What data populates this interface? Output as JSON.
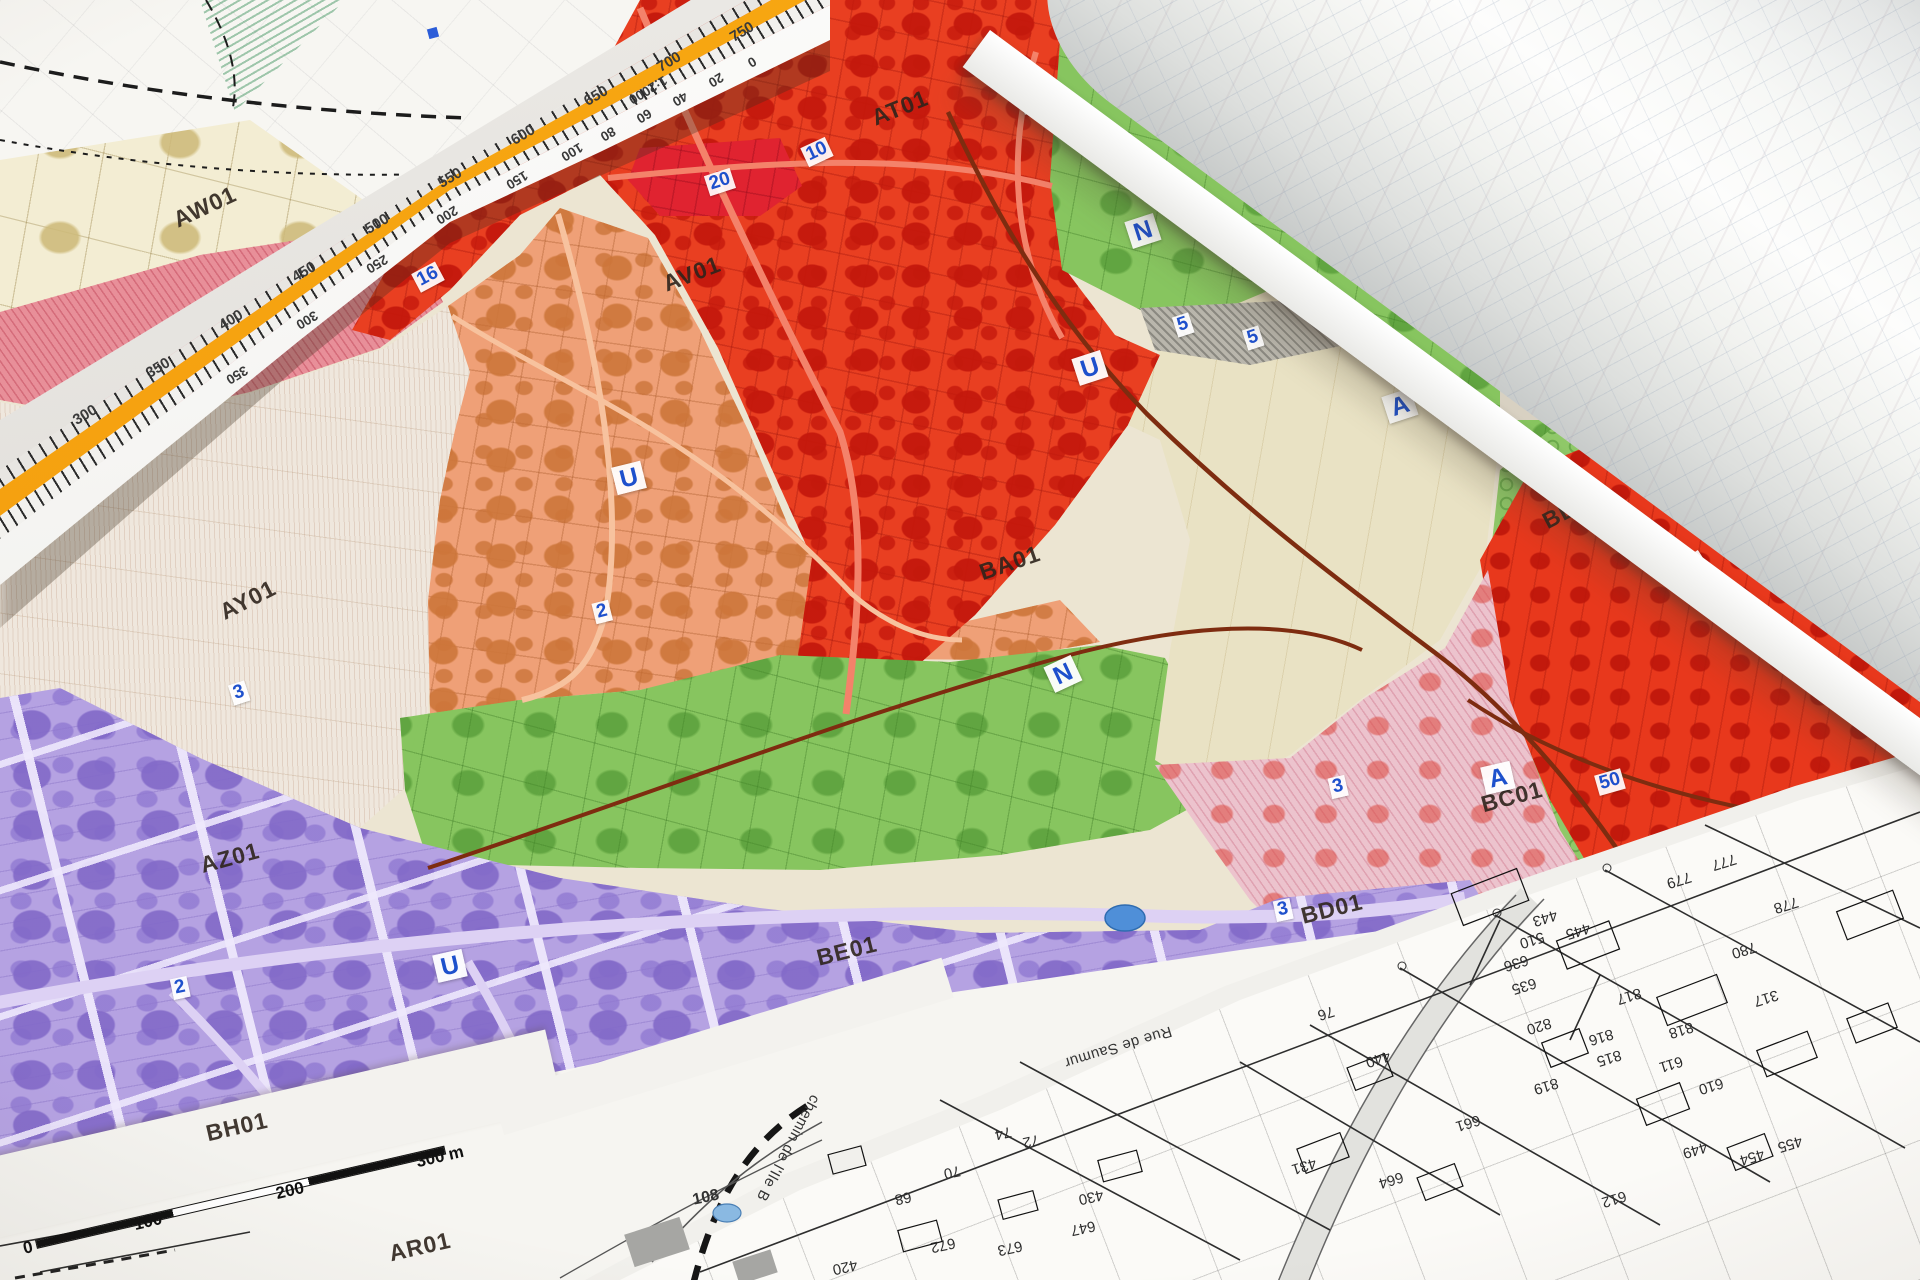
{
  "scene": {
    "description": "Photograph of paper town-planning zoning maps (PLU) with a triangular scale ruler, a rolled plan and cadastral parcel sheets"
  },
  "palette": {
    "zone_red": "#e93f21",
    "zone_orange": "#efa077",
    "zone_green": "#87c55f",
    "zone_purple": "#b5a2e2",
    "zone_cream": "#e9e2c4",
    "zone_pink": "#ecc3cd",
    "badge_blue": "#1e50cc",
    "ruler_orange": "#f59d0b"
  },
  "zoning_map": {
    "zone_labels": [
      {
        "t": "AW01",
        "x": 205,
        "y": 207,
        "r": -25
      },
      {
        "t": "AT01",
        "x": 900,
        "y": 108,
        "r": -22
      },
      {
        "t": "AV01",
        "x": 692,
        "y": 274,
        "r": -21
      },
      {
        "t": "AY01",
        "x": 248,
        "y": 600,
        "r": -27
      },
      {
        "t": "BA01",
        "x": 1010,
        "y": 563,
        "r": -19
      },
      {
        "t": "AZ01",
        "x": 230,
        "y": 858,
        "r": -15
      },
      {
        "t": "BB01",
        "x": 1572,
        "y": 508,
        "r": -28
      },
      {
        "t": "BC01",
        "x": 1512,
        "y": 797,
        "r": -15
      },
      {
        "t": "BD01",
        "x": 1332,
        "y": 909,
        "r": -14
      },
      {
        "t": "BE01",
        "x": 847,
        "y": 951,
        "r": -14
      },
      {
        "t": "BH01",
        "x": 237,
        "y": 1127,
        "r": -13
      },
      {
        "t": "AR01",
        "x": 420,
        "y": 1247,
        "r": -13
      }
    ],
    "class_badges": [
      {
        "t": "U",
        "x": 1035,
        "y": 97,
        "r": -18
      },
      {
        "t": "U",
        "x": 1090,
        "y": 368,
        "r": -18
      },
      {
        "t": "U",
        "x": 629,
        "y": 478,
        "r": -14
      },
      {
        "t": "U",
        "x": 1693,
        "y": 570,
        "r": -33
      },
      {
        "t": "U",
        "x": 450,
        "y": 966,
        "r": -13
      },
      {
        "t": "N",
        "x": 1143,
        "y": 231,
        "r": -18
      },
      {
        "t": "N",
        "x": 1063,
        "y": 674,
        "r": -25
      },
      {
        "t": "A",
        "x": 1400,
        "y": 406,
        "r": -18
      },
      {
        "t": "A",
        "x": 1498,
        "y": 778,
        "r": -13
      }
    ],
    "number_badges": [
      {
        "t": "10",
        "x": 817,
        "y": 152,
        "r": -25
      },
      {
        "t": "20",
        "x": 720,
        "y": 182,
        "r": -18
      },
      {
        "t": "16",
        "x": 428,
        "y": 277,
        "r": -28
      },
      {
        "t": "2",
        "x": 602,
        "y": 612,
        "r": -14
      },
      {
        "t": "2",
        "x": 180,
        "y": 988,
        "r": -12
      },
      {
        "t": "3",
        "x": 239,
        "y": 693,
        "r": -18
      },
      {
        "t": "3",
        "x": 1283,
        "y": 910,
        "r": -12
      },
      {
        "t": "3",
        "x": 1338,
        "y": 787,
        "r": -13
      },
      {
        "t": "5",
        "x": 1183,
        "y": 325,
        "r": -18
      },
      {
        "t": "5",
        "x": 1253,
        "y": 338,
        "r": -18
      },
      {
        "t": "50",
        "x": 1610,
        "y": 782,
        "r": -16
      }
    ],
    "scale_bar_labels": [
      {
        "t": "0",
        "x": 28,
        "y": 1248,
        "r": -13
      },
      {
        "t": "100",
        "x": 148,
        "y": 1222,
        "r": -13
      },
      {
        "t": "200",
        "x": 290,
        "y": 1191,
        "r": -13
      },
      {
        "t": "300 m",
        "x": 440,
        "y": 1157,
        "r": -13
      }
    ]
  },
  "ruler": {
    "top_numbers": [
      {
        "t": "300",
        "x": 85,
        "y": 415,
        "r": -31
      },
      {
        "t": "350",
        "x": 158,
        "y": 368,
        "r": -31
      },
      {
        "t": "400",
        "x": 231,
        "y": 320,
        "r": -31
      },
      {
        "t": "450",
        "x": 304,
        "y": 272,
        "r": -31
      },
      {
        "t": "500",
        "x": 377,
        "y": 224,
        "r": -31
      },
      {
        "t": "550",
        "x": 450,
        "y": 178,
        "r": -31
      },
      {
        "t": "600",
        "x": 523,
        "y": 135,
        "r": -31
      },
      {
        "t": "650",
        "x": 596,
        "y": 96,
        "r": -31
      },
      {
        "t": "700",
        "x": 669,
        "y": 62,
        "r": -31
      },
      {
        "t": "750",
        "x": 742,
        "y": 32,
        "r": -31
      }
    ],
    "bottom_numbers": [
      {
        "t": "1:2000",
        "x": 648,
        "y": 90,
        "r": 149
      },
      {
        "t": "0",
        "x": 752,
        "y": 62,
        "r": 149
      },
      {
        "t": "20",
        "x": 716,
        "y": 80,
        "r": 149
      },
      {
        "t": "40",
        "x": 680,
        "y": 99,
        "r": 149
      },
      {
        "t": "60",
        "x": 644,
        "y": 116,
        "r": 149
      },
      {
        "t": "80",
        "x": 608,
        "y": 134,
        "r": 149
      },
      {
        "t": "100",
        "x": 572,
        "y": 152,
        "r": 149
      },
      {
        "t": "150",
        "x": 517,
        "y": 180,
        "r": 149
      },
      {
        "t": "200",
        "x": 447,
        "y": 215,
        "r": 149
      },
      {
        "t": "250",
        "x": 377,
        "y": 264,
        "r": 149
      },
      {
        "t": "300",
        "x": 307,
        "y": 320,
        "r": 149
      },
      {
        "t": "350",
        "x": 237,
        "y": 375,
        "r": 149
      }
    ]
  },
  "cadastral_sheet": {
    "street_labels": [
      {
        "t": "Rue de Saumur",
        "x": 1118,
        "y": 1047,
        "r": 163
      },
      {
        "t": "chemin de l'Ile B",
        "x": 788,
        "y": 1148,
        "r": 118
      }
    ],
    "other_labels": [
      {
        "t": "108",
        "x": 706,
        "y": 1198,
        "r": -12
      }
    ],
    "parcel_numbers": [
      {
        "t": "443",
        "x": 1545,
        "y": 918,
        "r": 163
      },
      {
        "t": "445",
        "x": 1578,
        "y": 931,
        "r": 163
      },
      {
        "t": "510",
        "x": 1532,
        "y": 940,
        "r": 163
      },
      {
        "t": "636",
        "x": 1516,
        "y": 963,
        "r": 163
      },
      {
        "t": "635",
        "x": 1524,
        "y": 986,
        "r": 163
      },
      {
        "t": "820",
        "x": 1539,
        "y": 1026,
        "r": 163
      },
      {
        "t": "819",
        "x": 1546,
        "y": 1086,
        "r": 163
      },
      {
        "t": "816",
        "x": 1601,
        "y": 1037,
        "r": 163
      },
      {
        "t": "815",
        "x": 1609,
        "y": 1058,
        "r": 163
      },
      {
        "t": "817",
        "x": 1629,
        "y": 996,
        "r": 163
      },
      {
        "t": "818",
        "x": 1681,
        "y": 1030,
        "r": 163
      },
      {
        "t": "611",
        "x": 1671,
        "y": 1064,
        "r": 163
      },
      {
        "t": "610",
        "x": 1711,
        "y": 1086,
        "r": 163
      },
      {
        "t": "780",
        "x": 1744,
        "y": 950,
        "r": 163
      },
      {
        "t": "779",
        "x": 1679,
        "y": 880,
        "r": 163
      },
      {
        "t": "778",
        "x": 1786,
        "y": 905,
        "r": 163
      },
      {
        "t": "777",
        "x": 1724,
        "y": 862,
        "r": 163
      },
      {
        "t": "317",
        "x": 1766,
        "y": 998,
        "r": 163
      },
      {
        "t": "440",
        "x": 1378,
        "y": 1059,
        "r": 163
      },
      {
        "t": "76",
        "x": 1326,
        "y": 1013,
        "r": 163
      },
      {
        "t": "431",
        "x": 1304,
        "y": 1166,
        "r": 163
      },
      {
        "t": "661",
        "x": 1468,
        "y": 1123,
        "r": 163
      },
      {
        "t": "664",
        "x": 1391,
        "y": 1180,
        "r": 163
      },
      {
        "t": "449",
        "x": 1695,
        "y": 1150,
        "r": 163
      },
      {
        "t": "454",
        "x": 1752,
        "y": 1157,
        "r": 163
      },
      {
        "t": "455",
        "x": 1790,
        "y": 1144,
        "r": 163
      },
      {
        "t": "612",
        "x": 1614,
        "y": 1199,
        "r": 163
      },
      {
        "t": "672",
        "x": 943,
        "y": 1245,
        "r": 168
      },
      {
        "t": "673",
        "x": 1010,
        "y": 1248,
        "r": 168
      },
      {
        "t": "647",
        "x": 1083,
        "y": 1228,
        "r": 168
      },
      {
        "t": "430",
        "x": 1091,
        "y": 1197,
        "r": 168
      },
      {
        "t": "420",
        "x": 845,
        "y": 1267,
        "r": 168
      },
      {
        "t": "68",
        "x": 903,
        "y": 1198,
        "r": 168
      },
      {
        "t": "70",
        "x": 952,
        "y": 1172,
        "r": 168
      },
      {
        "t": "74",
        "x": 1003,
        "y": 1133,
        "r": 168
      },
      {
        "t": "72",
        "x": 1031,
        "y": 1141,
        "r": 168
      }
    ]
  }
}
